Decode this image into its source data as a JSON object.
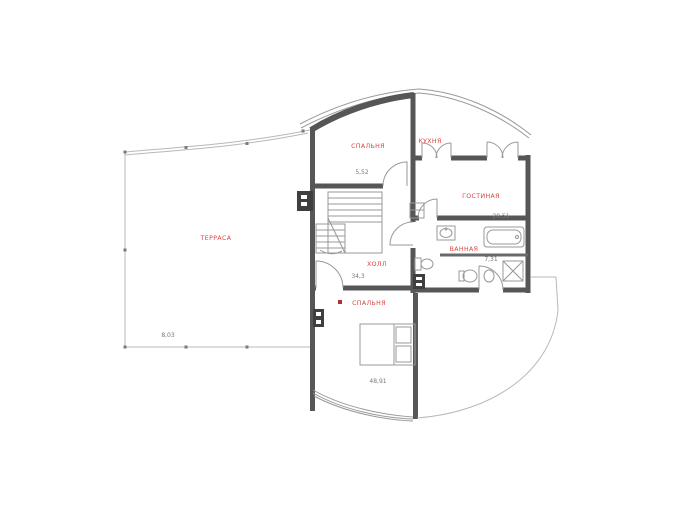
{
  "plan": {
    "type": "floor-plan",
    "colors": {
      "wall": "#565656",
      "partition_line": "#999999",
      "room_label": "#d94343",
      "dimension_text": "#787878",
      "background": "#ffffff"
    },
    "rooms": {
      "terrace": {
        "label": "ТЕРРАСА",
        "area": "8,03"
      },
      "bedroom1": {
        "label": "СПАЛЬНЯ",
        "area": "5,52"
      },
      "kitchen": {
        "label": "КУХНЯ"
      },
      "living": {
        "label": "ГОСТИНАЯ",
        "area": "20,51"
      },
      "bath": {
        "label": "ВАННАЯ",
        "area": "7,31"
      },
      "hall": {
        "label": "ХОЛЛ",
        "area": "34,3"
      },
      "bedroom2": {
        "label": "СПАЛЬНЯ",
        "area": "48,91"
      }
    }
  }
}
